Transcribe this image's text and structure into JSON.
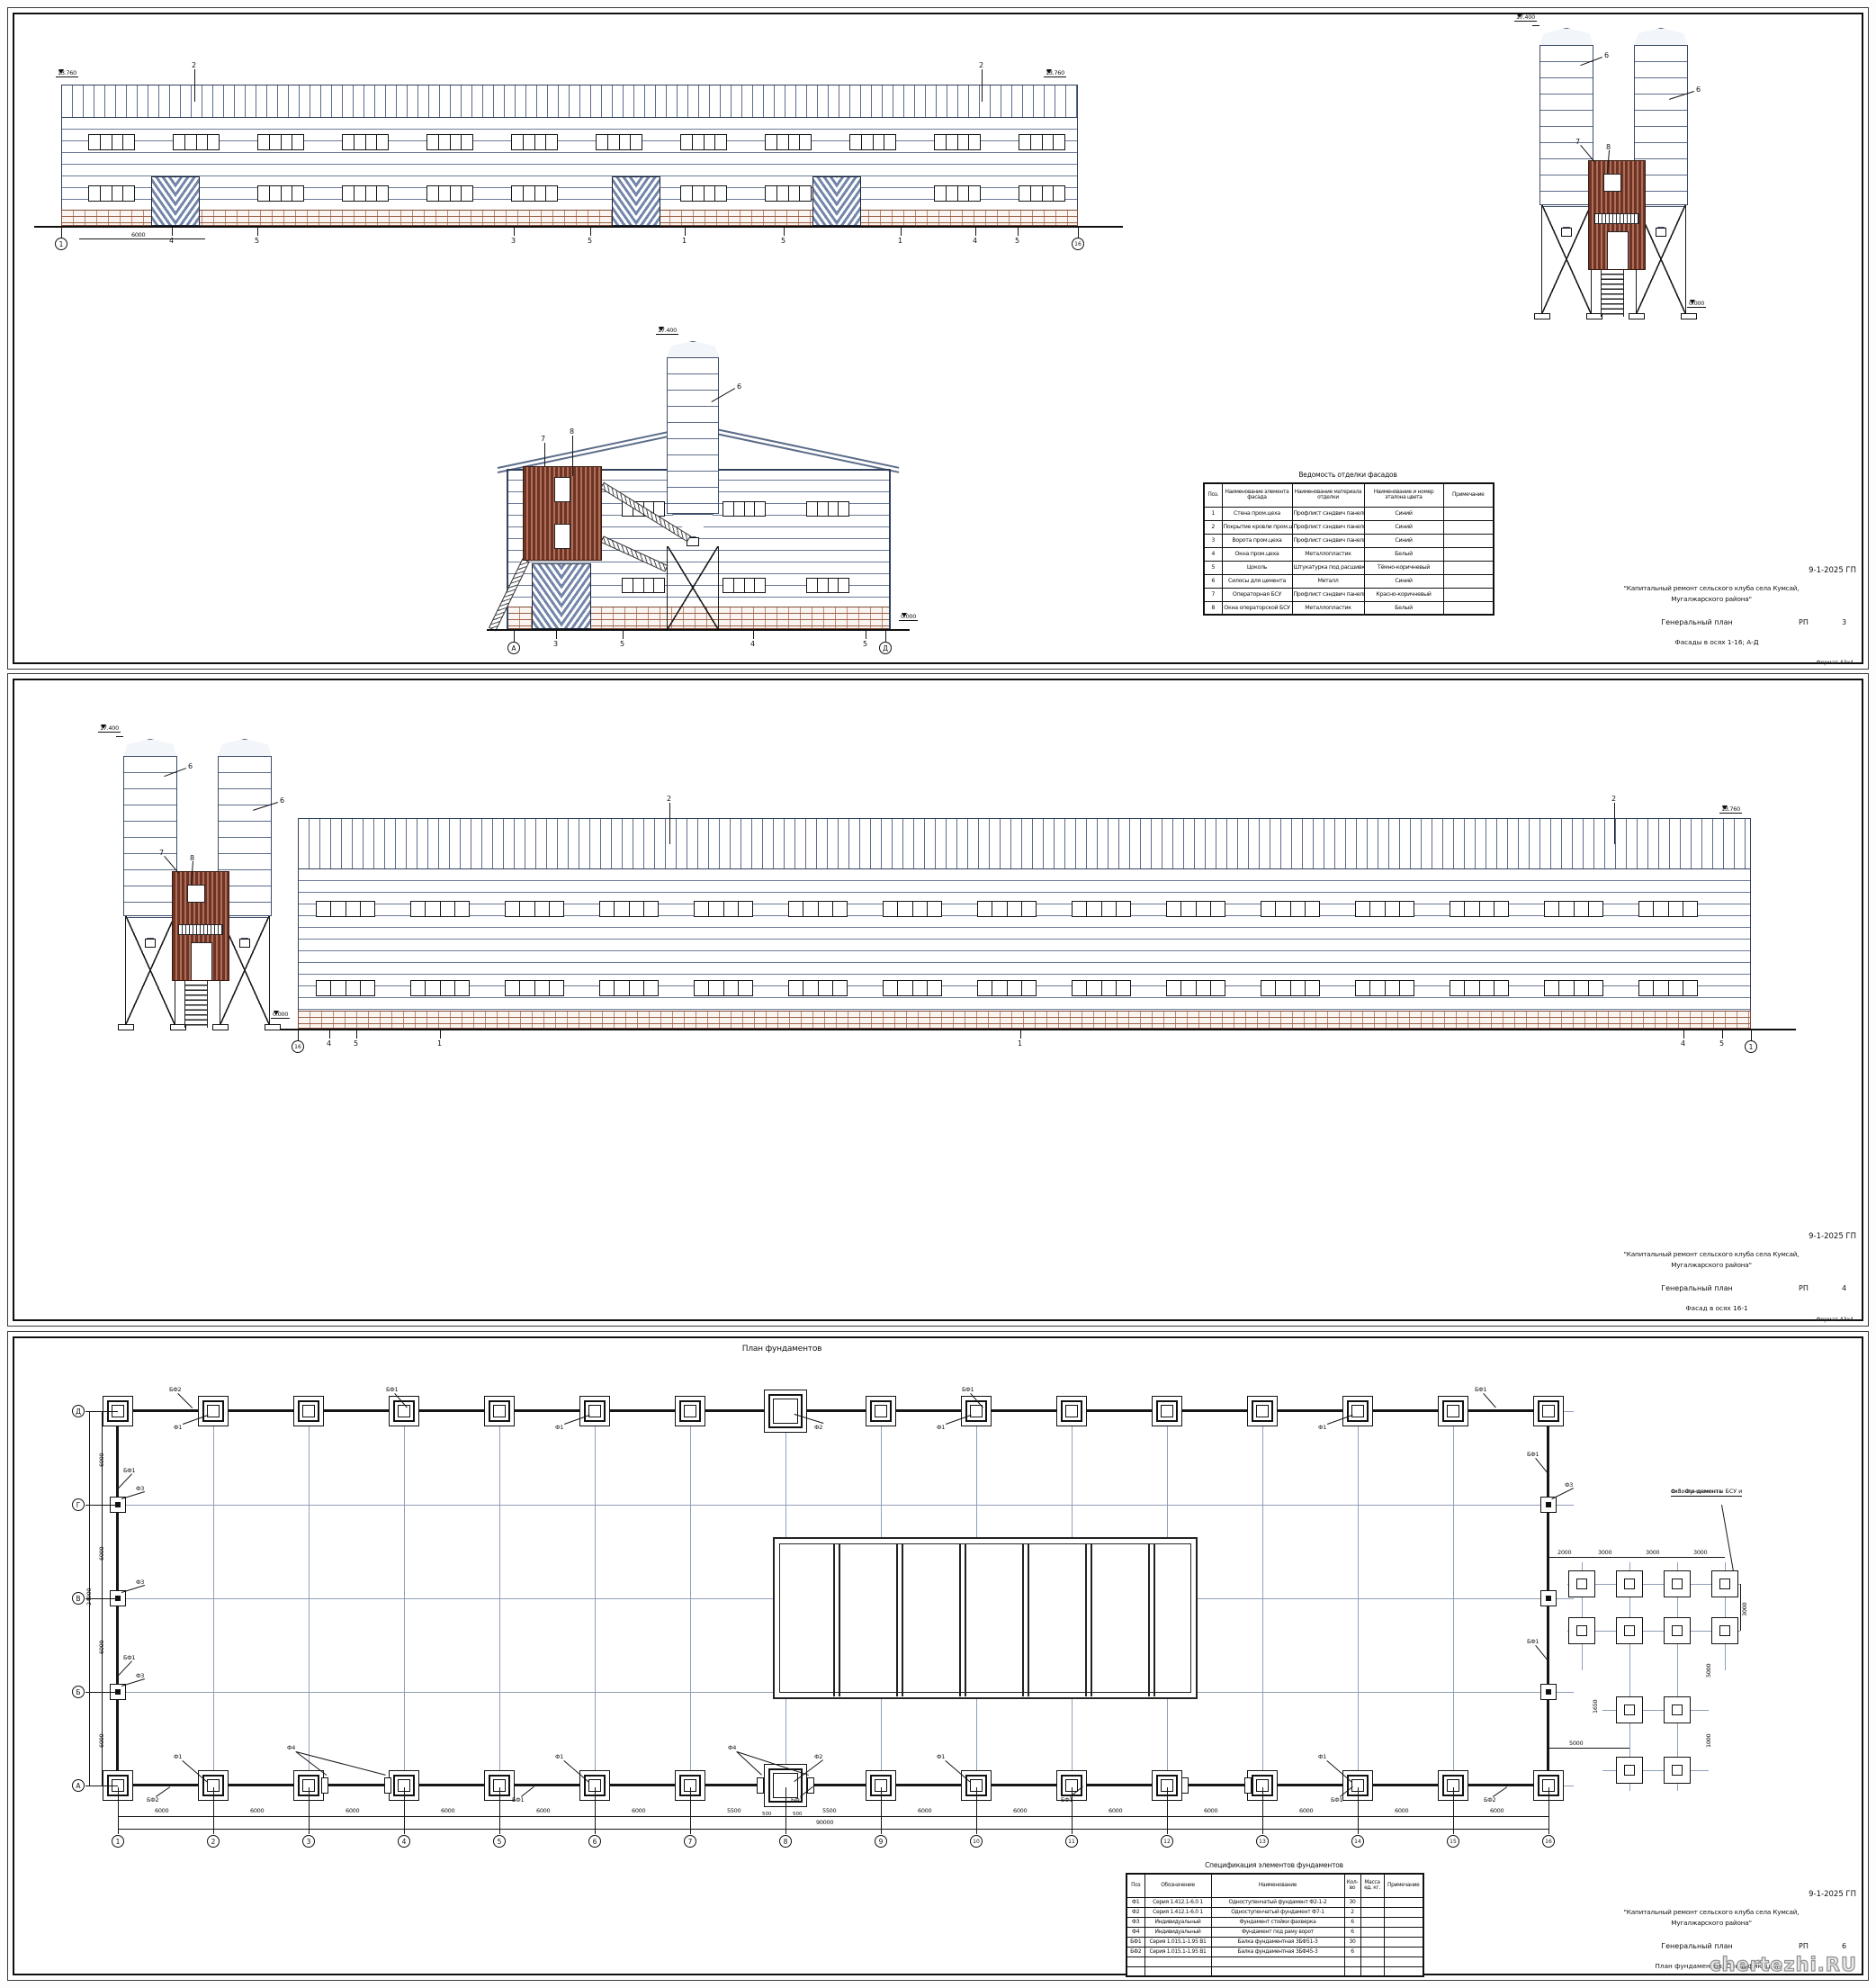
{
  "watermark": "chertezhi.RU",
  "titleblock_common": {
    "code": "9-1-2025 ГП",
    "project_line1": "\"Капитальный ремонт сельского клуба села Кумсай,",
    "project_line2": "Мугалжарского района\"",
    "doc_title": "Генеральный план",
    "stage": "РП"
  },
  "sheet1": {
    "sheet_no": "3",
    "sheet_caption": "Фасады в осях 1-16; А-Д",
    "format_note": "Формат А3х4",
    "facade_main": {
      "elev_left": "13.760",
      "elev_right": "13.760",
      "axis_left": "1",
      "axis_right": "16",
      "dim": "6000",
      "roof_callout": "2",
      "bottom_labels": [
        "4",
        "5",
        "3",
        "5",
        "1",
        "5",
        "1",
        "4",
        "5"
      ]
    },
    "silos": {
      "elev_top": "17.400",
      "elev_zero": "0.000",
      "silo_label": "6",
      "cabin_label": "7",
      "window_label": "8"
    },
    "gable": {
      "elev_top": "17.400",
      "elev_zero": "0.000",
      "axis_left": "А",
      "axis_right": "Д",
      "cabin_label": "7",
      "window_label": "8",
      "silo_label": "6",
      "bottom_labels": [
        "3",
        "5",
        "4",
        "5"
      ]
    },
    "finish_table": {
      "title": "Ведомость отделки фасадов",
      "headers": [
        "Поз.",
        "Наименование элемента фасада",
        "Наименование материала отделки",
        "Наименование и номер эталона цвета",
        "Примечание"
      ],
      "rows": [
        [
          "1",
          "Стена пром.цеха",
          "Профлист сэндвич панели",
          "Синий",
          ""
        ],
        [
          "2",
          "Покрытие кровли пром.цеха",
          "Профлист сэндвич панели",
          "Синий",
          ""
        ],
        [
          "3",
          "Ворота пром.цеха",
          "Профлист сэндвич панели",
          "Синий",
          ""
        ],
        [
          "4",
          "Окна пром.цеха",
          "Металлопластик",
          "Белый",
          ""
        ],
        [
          "5",
          "Цоколь",
          "Штукатурка под расшивку",
          "Тёмно-коричневый",
          ""
        ],
        [
          "6",
          "Силосы для цемента",
          "Металл",
          "Синий",
          ""
        ],
        [
          "7",
          "Операторная БСУ",
          "Профлист сэндвич панели",
          "Красно-коричневый",
          ""
        ],
        [
          "8",
          "Окна операторской БСУ",
          "Металлопластик",
          "Белый",
          ""
        ]
      ]
    }
  },
  "sheet2": {
    "sheet_no": "4",
    "sheet_caption": "Фасад в осях 16-1",
    "format_note": "Формат А3х4",
    "facade_main": {
      "elev_left": "13.760",
      "elev_right": "13.760",
      "axis_left": "16",
      "axis_right": "1",
      "roof_callout": "2",
      "bottom_labels": [
        "4",
        "5",
        "1",
        "1",
        "4",
        "5"
      ]
    },
    "silos": {
      "elev_top": "17.400",
      "elev_zero": "0.000",
      "silo_label": "6",
      "cabin_label": "7",
      "window_label": "8"
    }
  },
  "sheet3": {
    "sheet_no": "6",
    "sheet_caption": "План фундаментов; Спецификация",
    "plan_title": "План фундаментов",
    "axes_cols": [
      "1",
      "2",
      "3",
      "4",
      "5",
      "6",
      "7",
      "8",
      "9",
      "10",
      "11",
      "12",
      "13",
      "14",
      "15",
      "16"
    ],
    "axes_rows": [
      "Д",
      "Г",
      "В",
      "Б",
      "А"
    ],
    "dims_bays": [
      "6000",
      "6000",
      "6000",
      "6000",
      "6000",
      "6000",
      "5500",
      "5500",
      "6000",
      "6000",
      "6000",
      "6000",
      "6000",
      "6000",
      "6000"
    ],
    "dims_small": [
      "500",
      "500"
    ],
    "dim_total_bottom": "90000",
    "dims_left": [
      "6000",
      "6000",
      "6000",
      "6000"
    ],
    "dim_total_left": "24000",
    "bsu_note_line1": "Ф-5. Фундаменты БСУ и",
    "bsu_note_line2": "силосов цемента",
    "dims_bsu_top": [
      "2000",
      "3000",
      "3000",
      "3000"
    ],
    "dim_bsu_right": "3000",
    "dims_bsu_misc": [
      "5000",
      "1650",
      "1000",
      "5000"
    ],
    "fnd_labels": {
      "f1": "Ф1",
      "f2": "Ф2",
      "f3": "Ф3",
      "f4": "Ф4",
      "bf1": "БФ1",
      "bf2": "БФ2"
    },
    "spec_table": {
      "title": "Спецификация элементов фундаментов",
      "headers": [
        "Поз",
        "Обозначение",
        "Наименование",
        "Кол-во",
        "Масса ед. кг.",
        "Примечание"
      ],
      "rows": [
        [
          "Ф1",
          "Серия 1.412.1-6.0 1",
          "Одноступенчатый фундамент Ф2-1-2",
          "30",
          "",
          ""
        ],
        [
          "Ф2",
          "Серия 1.412.1-6.0 1",
          "Одноступенчатый фундамент Ф7-1",
          "2",
          "",
          ""
        ],
        [
          "Ф3",
          "Индивидуальный",
          "Фундамент стойки фахверка",
          "6",
          "",
          ""
        ],
        [
          "Ф4",
          "Индивидуальный",
          "Фундамент под раму ворот",
          "6",
          "",
          ""
        ],
        [
          "БФ1",
          "Серия 1.015.1-1.95 В1",
          "Балка фундаментная 3БФ51-3",
          "30",
          "",
          ""
        ],
        [
          "БФ2",
          "Серия 1.015.1-1.95 В1",
          "Балка фундаментная 3БФ45-3",
          "6",
          "",
          ""
        ],
        [
          "",
          "",
          "",
          "",
          "",
          ""
        ],
        [
          "",
          "",
          "",
          "",
          "",
          ""
        ]
      ]
    }
  }
}
